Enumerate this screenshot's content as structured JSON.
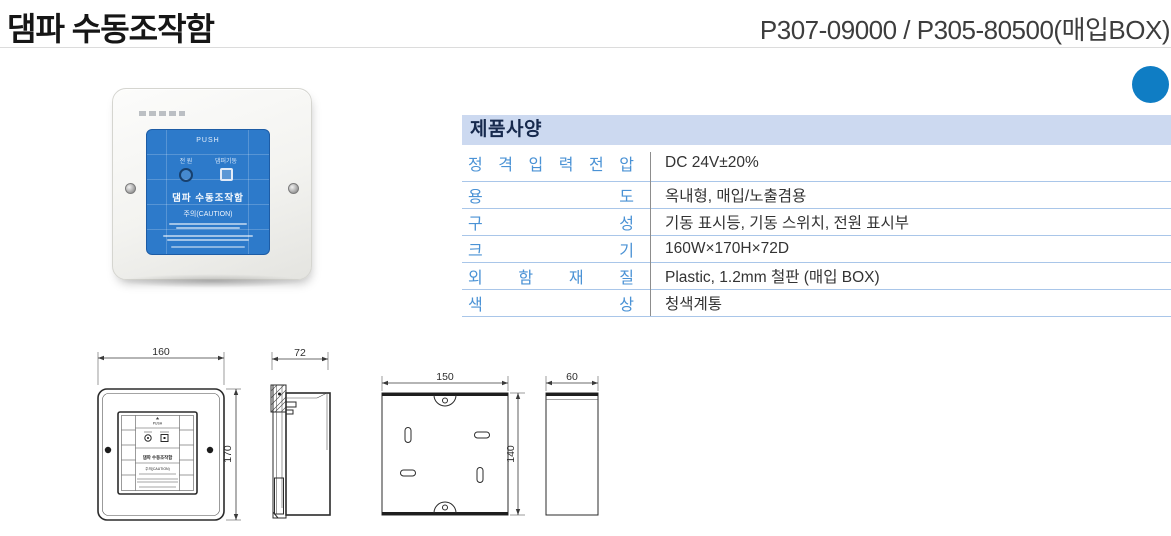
{
  "header": {
    "title": "댐파 수동조작함",
    "model": "P307-09000 / P305-80500(매입BOX)"
  },
  "colors": {
    "accent_dot": "#0f7dc4",
    "spec_band_bg": "#ccd9f0",
    "spec_label_blue": "#4a92d5",
    "spec_row_line": "#a9c6e9",
    "panel_blue": "#2d7aca"
  },
  "spec": {
    "section_title": "제품사양",
    "rows": [
      {
        "label": "정 격 입 력 전 압",
        "value": "DC 24V±20%"
      },
      {
        "label": "용 도",
        "value": "옥내형, 매입/노출겸용"
      },
      {
        "label": "구 성",
        "value": "기동 표시등, 기동 스위치, 전원 표시부"
      },
      {
        "label": "크 기",
        "value": "160W×170H×72D"
      },
      {
        "label": "외 함 재 질",
        "value": "Plastic, 1.2mm 철판 (매입 BOX)"
      },
      {
        "label": "색 상",
        "value": "청색계통"
      }
    ]
  },
  "photo": {
    "push_label": "PUSH",
    "power_label": "전 원",
    "damper_label": "댐퍼기동",
    "name_label": "댐파 수동조작함",
    "caution_label": "주의(CAUTION)"
  },
  "drawings": {
    "front": {
      "width_dim": "160",
      "height_dim": "170",
      "push": "PUSH",
      "panel_name": "댐파 수동조작함",
      "panel_caution": "주의(CAUTION)"
    },
    "side": {
      "depth_dim": "72"
    },
    "box_front": {
      "width_dim": "150",
      "height_dim": "140"
    },
    "box_side": {
      "depth_dim": "60"
    }
  },
  "icons": {
    "power_indicator": "circle-lamp",
    "damper_switch": "square-button",
    "screw": "round-screw-head",
    "accent_dot": "filled-circle"
  }
}
